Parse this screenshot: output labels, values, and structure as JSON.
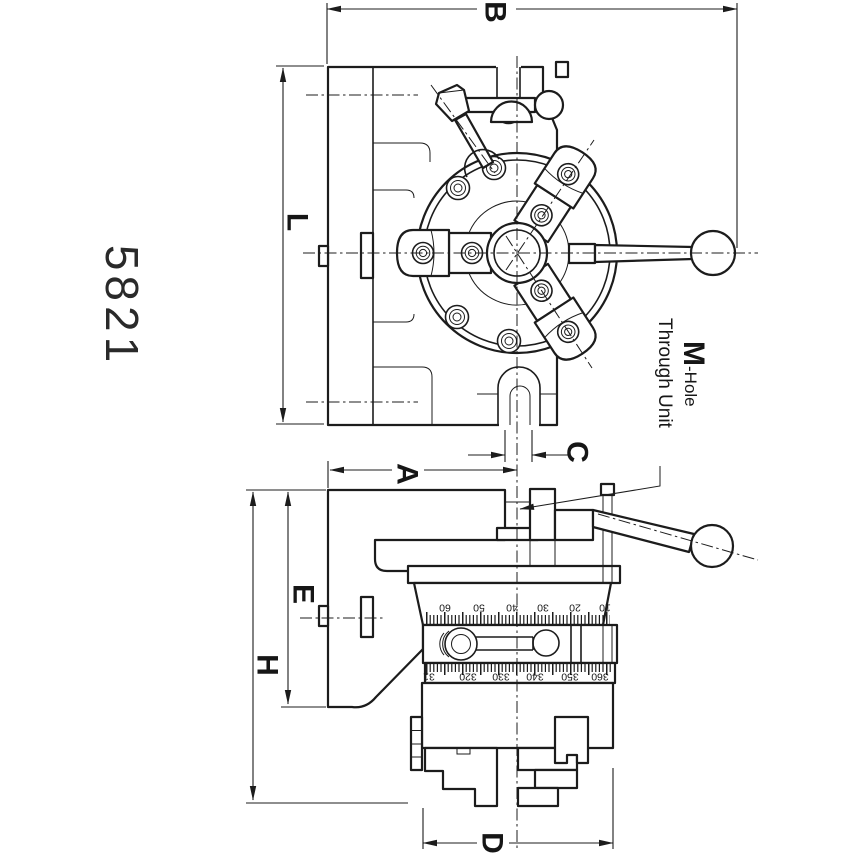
{
  "colors": {
    "line": "#1c1c1c",
    "background": "#ffffff"
  },
  "part_number": "5821",
  "dimension_labels": {
    "B": "B",
    "L": "L",
    "C": "C",
    "A": "A",
    "E": "E",
    "H": "H",
    "D": "D"
  },
  "callout": {
    "symbol": "M",
    "suffix": "-Hole",
    "line2": "Through Unit"
  },
  "vernier_scale": [
    "60",
    "50",
    "40",
    "30",
    "20",
    "10"
  ],
  "degree_scale": [
    "31",
    "320",
    "330",
    "340",
    "350",
    "360"
  ]
}
